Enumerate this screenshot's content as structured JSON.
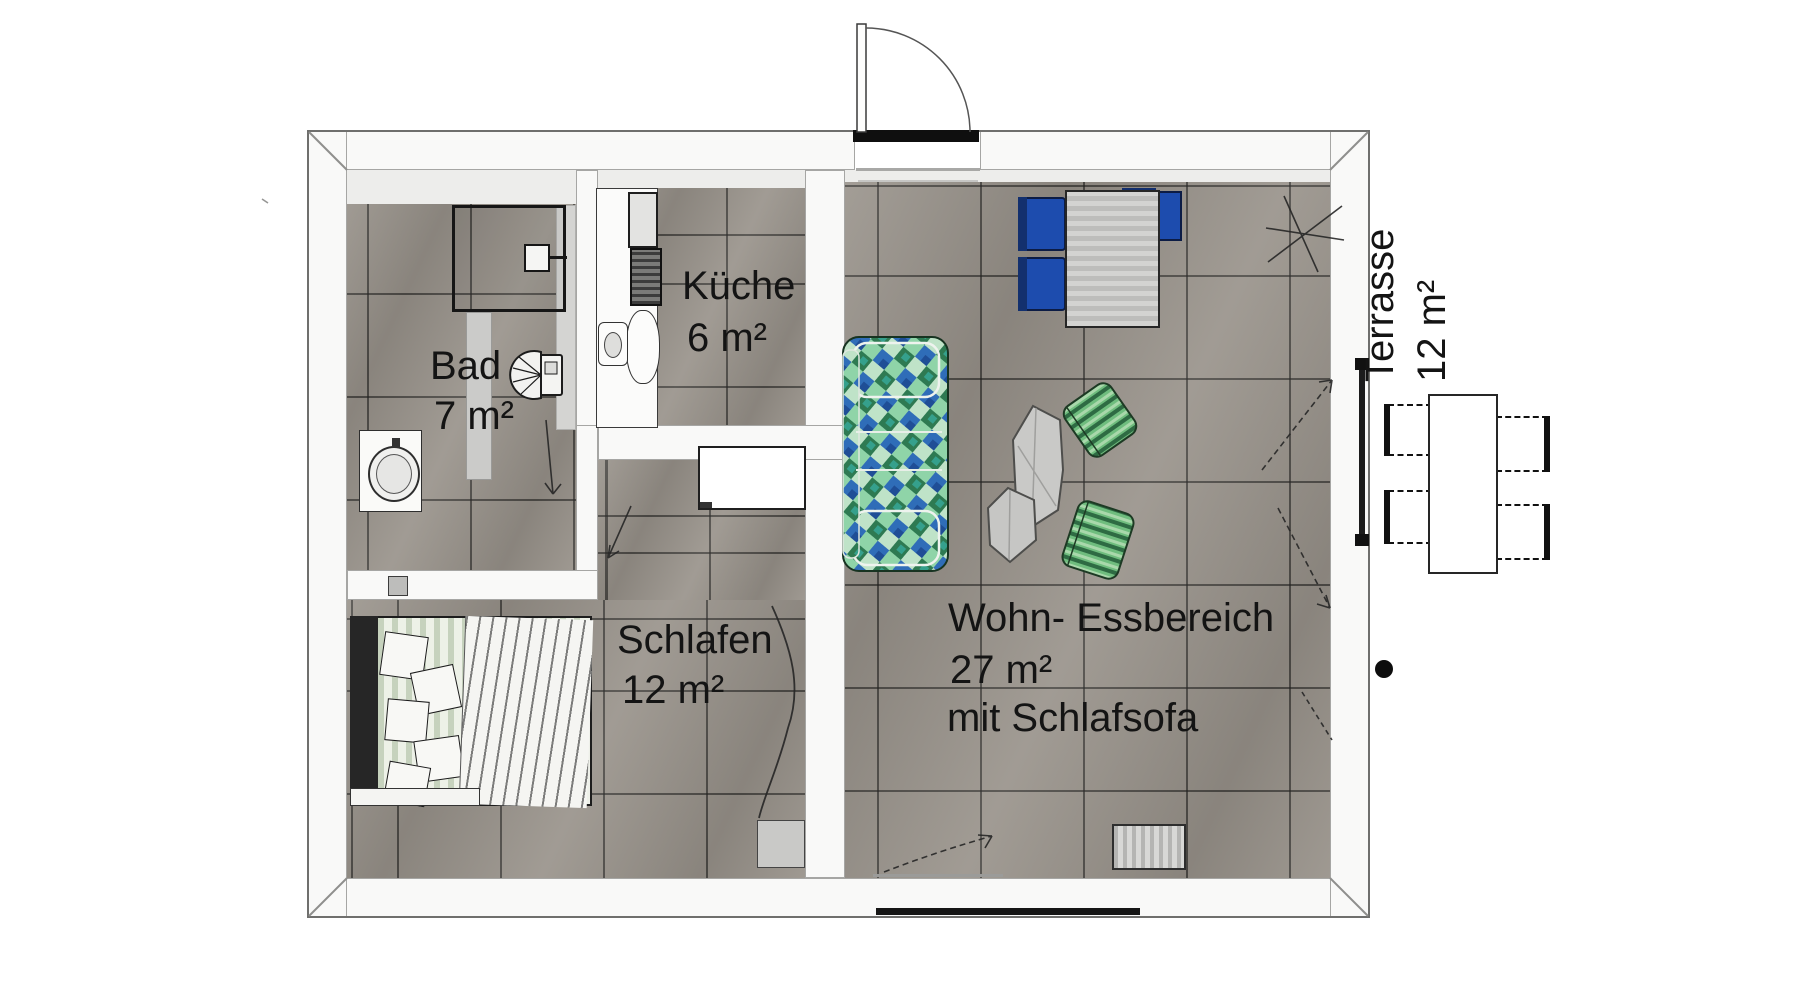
{
  "plan": {
    "type": "apartment-floor-plan",
    "rooms": [
      {
        "name": "Bad",
        "area": "7 m²"
      },
      {
        "name": "Küche",
        "area": "6 m²"
      },
      {
        "name": "Schlafen",
        "area": "12 m²"
      },
      {
        "name": "Wohn- Essbereich",
        "area": "27 m²",
        "note": "mit Schlafsofa"
      },
      {
        "name": "Terrasse",
        "area": "12 m²"
      }
    ],
    "furniture": {
      "bad": [
        "shower",
        "toilet",
        "washbasin"
      ],
      "kueche": [
        "kitchen-counter",
        "fridge",
        "stove",
        "sink"
      ],
      "schlafen": [
        "double-bed",
        "pillows",
        "blanket",
        "desk",
        "radiator"
      ],
      "wohn": [
        "dining-table",
        "blue-dining-chairs",
        "sleeper-sofa",
        "coffee-tables",
        "green-armchairs",
        "radiator",
        "window"
      ],
      "terrasse": [
        "outdoor-table",
        "outdoor-chairs"
      ]
    },
    "features": [
      "entrance-door-top",
      "terrace-door-right",
      "door-handle-dot",
      "pencil-annotations"
    ],
    "colors": {
      "tile_gray": "#99938b",
      "grout": "#3e3d3b",
      "wall_white": "#f9f9f8",
      "outline_gray": "#6f6f6d",
      "chair_blue": "#1d4cae",
      "chair_navy": "#0c1c45",
      "sofa_green": "#58b57c",
      "sofa_blue": "#2f6db8",
      "sofa_teal": "#35a08c",
      "armchair_green": "#6fbd7e",
      "mattress_green": "#e7ecdf",
      "headboard_dark": "#262626",
      "radiator_gray": "#c9c9c7"
    }
  }
}
